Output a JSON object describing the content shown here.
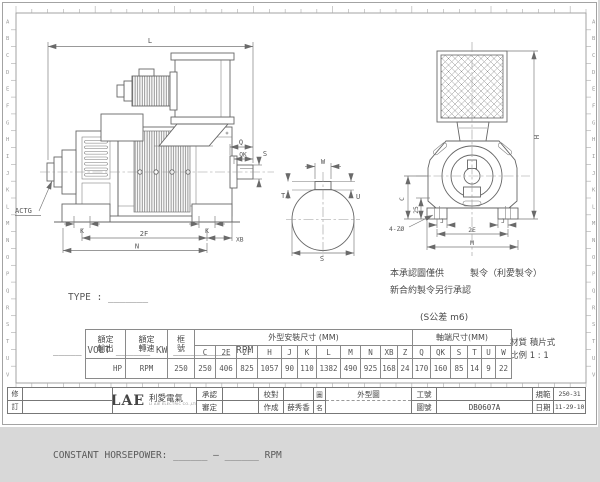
{
  "frame": {
    "row_letters": [
      "A",
      "B",
      "C",
      "D",
      "E",
      "F",
      "G",
      "H",
      "I",
      "J",
      "K",
      "L",
      "M",
      "N",
      "O",
      "P",
      "Q",
      "R",
      "S",
      "T",
      "U",
      "V"
    ]
  },
  "views": {
    "labels": {
      "L": "L",
      "Q": "Q",
      "QK": "QK",
      "S": "S",
      "T": "T",
      "U": "U",
      "W": "W",
      "K": "K",
      "2F": "2F",
      "XB": "XB",
      "N": "N",
      "H": "H",
      "C": "C",
      "25": "25",
      "J": "J",
      "2E": "2E",
      "M": "M",
      "holes": "4-ZØ",
      "actg": "ACTG"
    }
  },
  "specs": {
    "line1": "TYPE : _______",
    "line2": "_____ VOLT ______ KW __________ RPM",
    "line3": "CONSTANT TORQUE: ______ — ______ RPM",
    "line4": "CONSTANT HORSEPOWER: ______ — ______ RPM"
  },
  "notes": {
    "approval_left": "本承認圖僅供",
    "approval_right": "製令（利愛製令）",
    "approval_line2": "新合約製令另行承認",
    "tolerance": "(S公差 m6)",
    "material": "材質 積片式",
    "scale": "比例 1 : 1"
  },
  "table": {
    "output_header": "額定輸出",
    "speed_header": "額定轉速",
    "frame_header": "框號",
    "group1": "外型安裝尺寸 (MM)",
    "group2": "軸端尺寸(MM)",
    "cols1": [
      "C",
      "2E",
      "2F",
      "H",
      "J",
      "K",
      "L",
      "M",
      "N",
      "XB",
      "Z"
    ],
    "cols2": [
      "Q",
      "QK",
      "S",
      "T",
      "U",
      "W"
    ],
    "output_value": "HP",
    "speed_value": "RPM",
    "frame_value": "250",
    "values1": [
      "250",
      "406",
      "825",
      "1057",
      "90",
      "110",
      "1382",
      "490",
      "925",
      "168",
      "24"
    ],
    "values2": [
      "170",
      "160",
      "85",
      "14",
      "9",
      "22"
    ]
  },
  "titleblock": {
    "rev_top": "修",
    "rev_bottom": "訂",
    "logo": "LAE",
    "logo_cn": "利愛電氣",
    "logo_sub": "LI AIE ELECTRIC CO.,LTD",
    "approve": "承認",
    "review": "審定",
    "proof": "校對",
    "author": "作成",
    "author_name": "薛秀香",
    "name_top": "圖",
    "name_bottom": "名",
    "drawing_name": "外型圖",
    "work_no": "工號",
    "drawing_no": "圖號",
    "drawing_no_value": "DB0607A",
    "spec": "規範",
    "spec_value": "250-31",
    "date": "日期",
    "date_value": "11-29-10"
  }
}
